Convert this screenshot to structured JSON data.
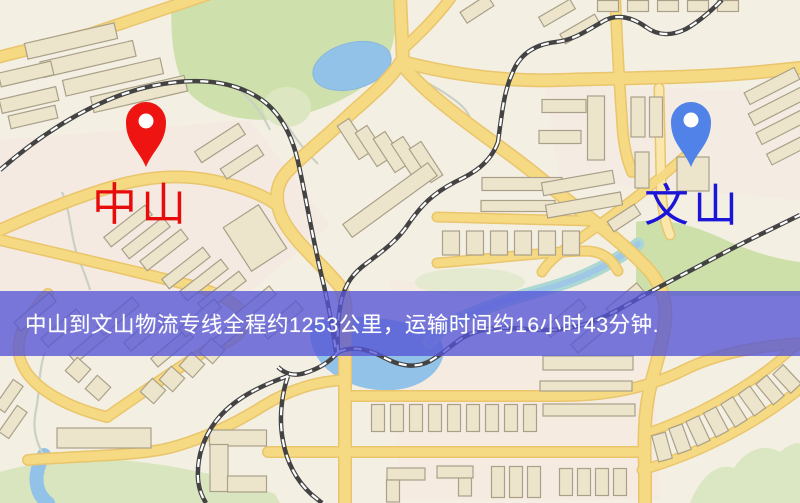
{
  "banner": {
    "text": "中山到文山物流专线全程约1253公里，运输时间约16小时43分钟.",
    "background_color": "#5454d6",
    "text_color": "#ffffff"
  },
  "markers": {
    "origin": {
      "label": "中山",
      "label_color": "#e80b0b",
      "pin_color": "#ee1411",
      "pin_icon": "map-pin"
    },
    "destination": {
      "label": "文山",
      "label_color": "#1b15d8",
      "pin_color": "#5082e8",
      "pin_icon": "map-pin"
    }
  },
  "route": {
    "origin": "中山",
    "destination": "文山",
    "distance": "约1253公里",
    "duration": "约16小时43分钟"
  },
  "map": {
    "base_color": "#f4efe2",
    "road_color": "#f6d87e",
    "park_color": "#cddfa9",
    "water_color": "#8fc0e8",
    "railway_color": "#3c3c3c"
  }
}
